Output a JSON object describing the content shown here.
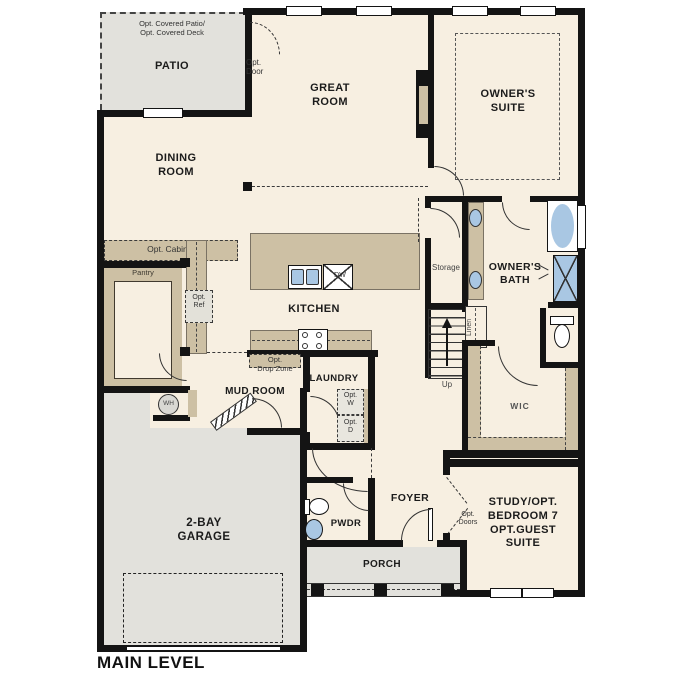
{
  "title": "MAIN LEVEL",
  "colors": {
    "floor_cream": "#f7efe1",
    "hard_surface_gray": "#e2e1dc",
    "cabinet_tan": "#cdc0a4",
    "wall_black": "#141414",
    "fixture_blue": "#a9c7e3"
  },
  "rooms": {
    "patio": {
      "note": "Opt. Covered Patio/\nOpt. Covered Deck",
      "label": "PATIO"
    },
    "great_room": {
      "label": "GREAT\nROOM"
    },
    "owners_suite": {
      "label": "OWNER'S\nSUITE"
    },
    "dining_room": {
      "label": "DINING\nROOM"
    },
    "kitchen": {
      "label": "KITCHEN"
    },
    "owners_bath": {
      "label": "OWNER'S\nBATH"
    },
    "mud_room": {
      "label": "MUD ROOM"
    },
    "laundry": {
      "label": "LAUNDRY"
    },
    "wic": {
      "label": "WIC"
    },
    "garage": {
      "label": "2-BAY\nGARAGE"
    },
    "pwdr": {
      "label": "PWDR"
    },
    "foyer": {
      "label": "FOYER"
    },
    "porch": {
      "label": "PORCH"
    },
    "study": {
      "label": "STUDY/OPT.\nBEDROOM 7\nOPT.GUEST\nSUITE"
    }
  },
  "annotations": {
    "opt_door": "Opt.\nDoor",
    "opt_cabinet": "Opt. Cabinet",
    "pantry": "Pantry",
    "opt_ref": "Opt.\nRef",
    "storage": "Storage",
    "linen": "Linen",
    "up": "Up",
    "opt_drop_zone": "Opt.\nDrop Zone",
    "opt_w": "Opt.\nW",
    "opt_d": "Opt.\nD",
    "wh": "WH",
    "dw": "DW",
    "opt_doors": "Opt.\nDoors"
  }
}
